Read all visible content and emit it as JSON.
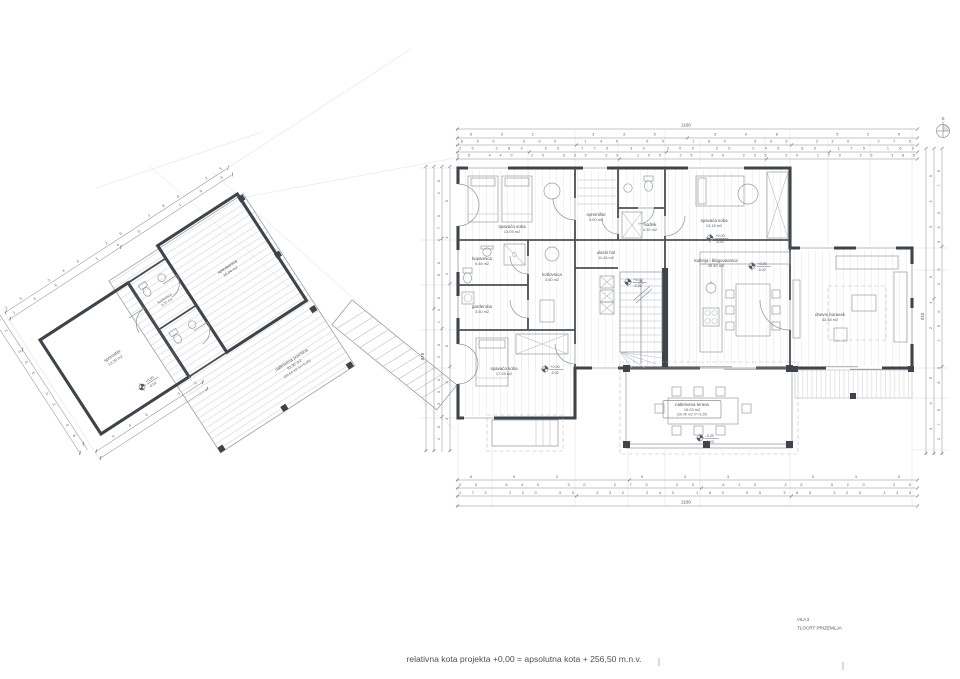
{
  "meta": {
    "sheet_title": "VILA 2",
    "drawing_title": "TLOCRT PRIZEMLJA",
    "footer_note": "relativna kota projekta +0,00 = apsolutna kota + 256,50 m.n.v.",
    "north_label": "S"
  },
  "colors": {
    "ink": "#53585e",
    "wall": "#3f444a",
    "thin_line": "#c5c9ce",
    "paper": "#ffffff"
  },
  "rooms": [
    {
      "name": "spavaća soba",
      "area": "13.05 m2"
    },
    {
      "name": "kupaonica",
      "area": "5.46 m2"
    },
    {
      "name": "kotlovnica",
      "area": "3.60 m2"
    },
    {
      "name": "garderoba",
      "area": "3.50 m2"
    },
    {
      "name": "spavaća soba",
      "area": "17.28 m2"
    },
    {
      "name": "spremište",
      "area": "5.00 m2"
    },
    {
      "name": "hodnik",
      "area": "4.20 m2"
    },
    {
      "name": "spavaća soba",
      "area": "13.18 m2"
    },
    {
      "name": "ulazni hol",
      "area": "11.46 m2"
    },
    {
      "name": "kuhinja i blagovaonica",
      "area": "35.40 m2"
    },
    {
      "name": "dnevni boravak",
      "area": "33.48 m2"
    },
    {
      "name": "natkrivena terasa",
      "area": "15.03 m2",
      "note": "(30.45 m2 h=-0,20)"
    },
    {
      "name": "spavaonica",
      "area": "16.04 m2"
    },
    {
      "name": "spremište",
      "area": "13.20 m2"
    },
    {
      "name": "natkrivena površina",
      "area": "91.92 m2",
      "note": "(93.64 m2 h=+0,00)"
    },
    {
      "name": "kupaonica",
      "area": "3.20 m2"
    }
  ],
  "levels": [
    {
      "a": "+0,00",
      "b": "-0,02"
    },
    {
      "a": "+0,00",
      "b": "-0,02"
    },
    {
      "a": "+0,00",
      "b": "-0,02"
    },
    {
      "a": "+0,00",
      "b": "-0,02"
    },
    {
      "a": "-0,20",
      "b": "-0,22"
    },
    {
      "a": "+0,00",
      "b": "-0,02"
    }
  ],
  "dims": {
    "top_total": "2160",
    "top": [
      [
        "692",
        "335",
        "608",
        "525"
      ],
      [
        "650",
        "300",
        "140",
        "60",
        "160",
        "345",
        "230",
        "275"
      ],
      [
        "25",
        "280",
        "90",
        "775",
        "30",
        "300",
        "20",
        "245",
        "60",
        "175",
        "160"
      ],
      [
        "25",
        "440",
        "20",
        "330",
        "20",
        "100",
        "25",
        "90",
        "235",
        "20",
        "170",
        "25",
        "385"
      ]
    ],
    "bottom": [
      [
        "692",
        "933",
        "535"
      ],
      [
        "25",
        "640",
        "30",
        "270",
        "20",
        "610",
        "25",
        "520",
        "20"
      ],
      [
        "170",
        "120",
        "90",
        "330",
        "240",
        "160",
        "95",
        "385",
        "200",
        "135"
      ]
    ],
    "bottom_total": "2160",
    "left": [
      [
        "25",
        "300",
        "20",
        "140",
        "90",
        "275",
        "25"
      ],
      [
        "430",
        "445"
      ]
    ],
    "left_total": "875",
    "right": [
      [
        "275",
        "60",
        "150",
        "20",
        "330",
        "75"
      ],
      [
        "335",
        "240",
        "335"
      ]
    ],
    "right_total": "910",
    "annex_top": [
      [
        "155",
        "140",
        "195"
      ],
      [
        "25",
        "240",
        "20",
        "180",
        "25"
      ]
    ],
    "annex_left": [
      "90",
      "20",
      "330",
      "25"
    ],
    "annex_bottom": [
      "440",
      "50"
    ]
  }
}
